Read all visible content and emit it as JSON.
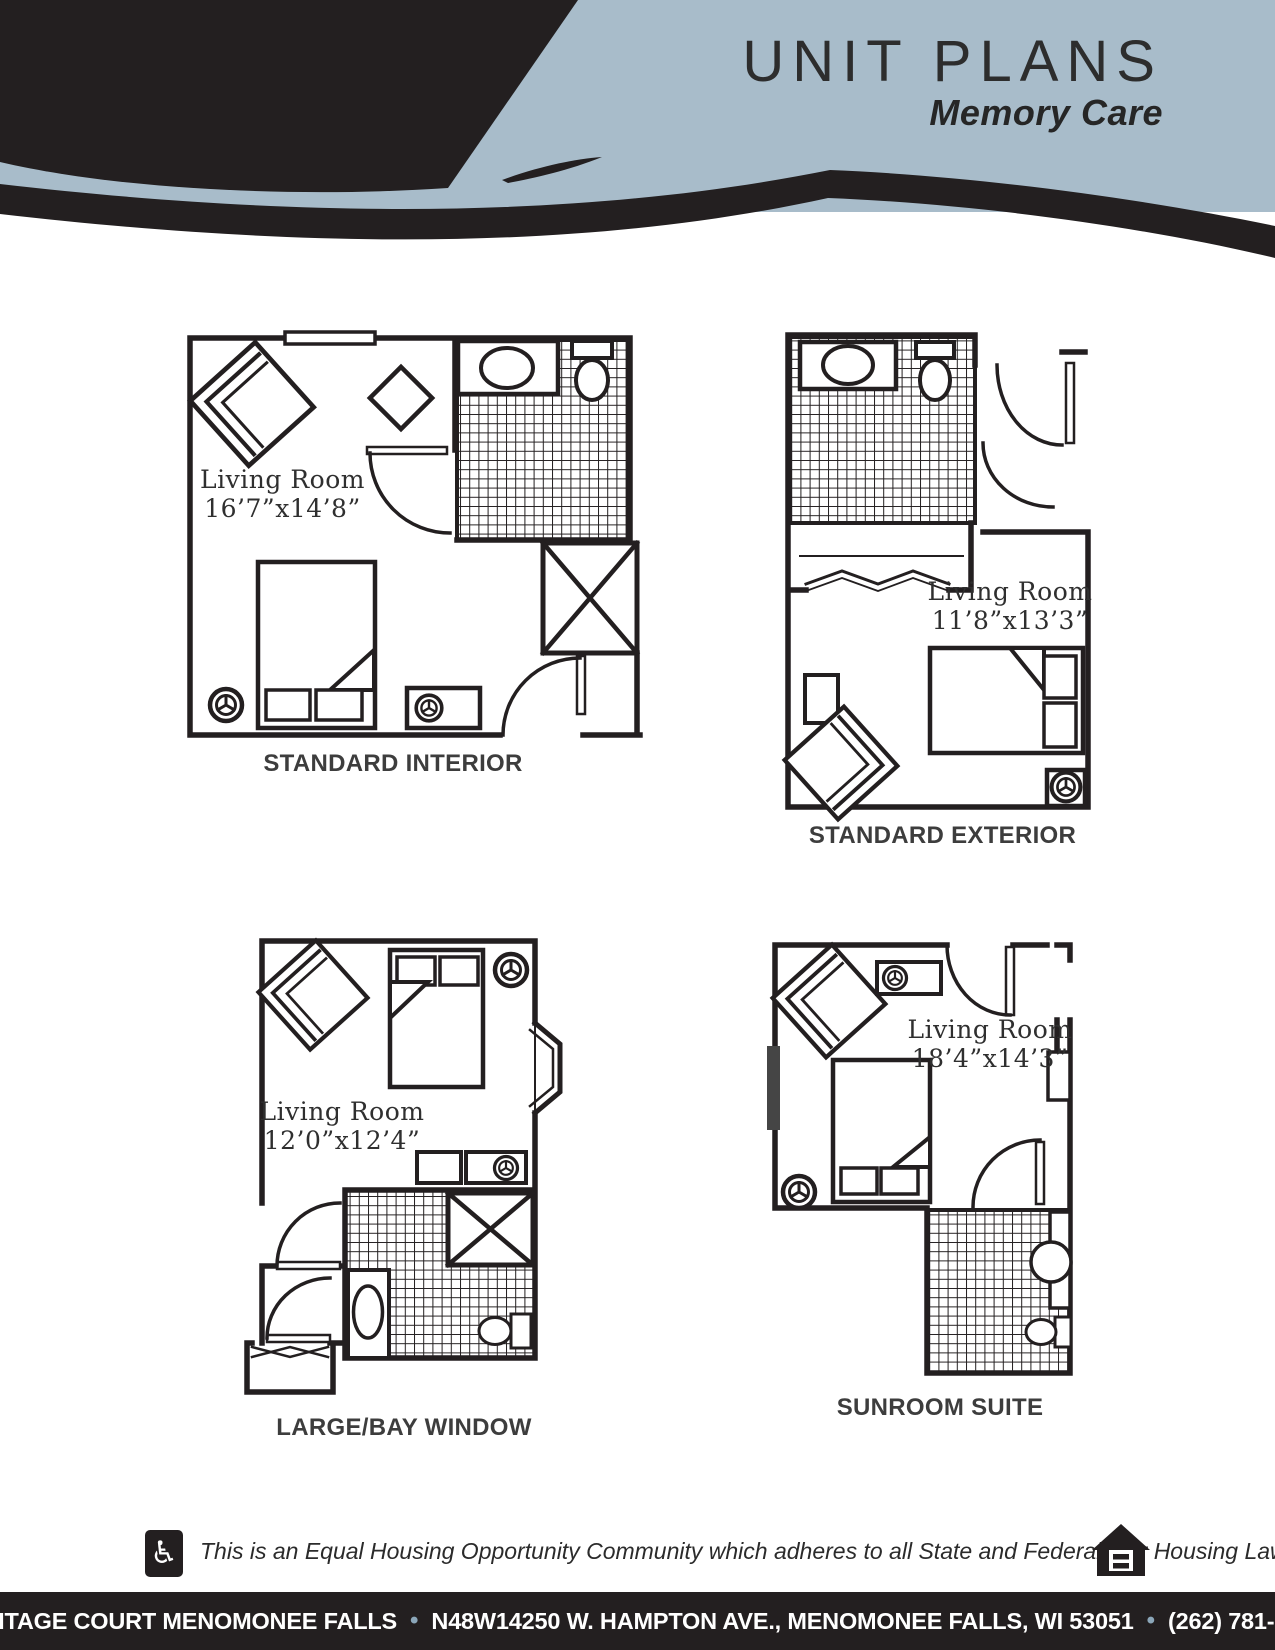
{
  "header": {
    "title": "UNIT PLANS",
    "subtitle": "Memory Care",
    "accent_color": "#a8bcca",
    "ink_color": "#231f20"
  },
  "plans": [
    {
      "name": "STANDARD INTERIOR",
      "room_label": "Living Room",
      "dimensions": "16’7”x14’8”"
    },
    {
      "name": "STANDARD EXTERIOR",
      "room_label": "Living Room",
      "dimensions": "11’8”x13’3”"
    },
    {
      "name": "LARGE/BAY WINDOW",
      "room_label": "Living Room",
      "dimensions": "12’0”x12’4”"
    },
    {
      "name": "SUNROOM SUITE",
      "room_label": "Living Room",
      "dimensions": "18’4”x14’3”"
    }
  ],
  "footer": {
    "notice": "This is an Equal Housing Opportunity Community which adheres to all State and Federal Fair Housing Laws.",
    "wheelchair_glyph": "♿",
    "icons": {
      "accessible": "wheelchair-icon",
      "equal_housing": "equal-housing-logo"
    }
  },
  "footer_bar": {
    "name": "HERITAGE COURT MENOMONEE FALLS",
    "separator": "•",
    "address": "N48W14250 W. HAMPTON AVE., MENOMONEE FALLS, WI 53051",
    "phone": "(262) 781-6930",
    "bar_color": "#231f20",
    "separator_color": "#8ba6b9"
  }
}
